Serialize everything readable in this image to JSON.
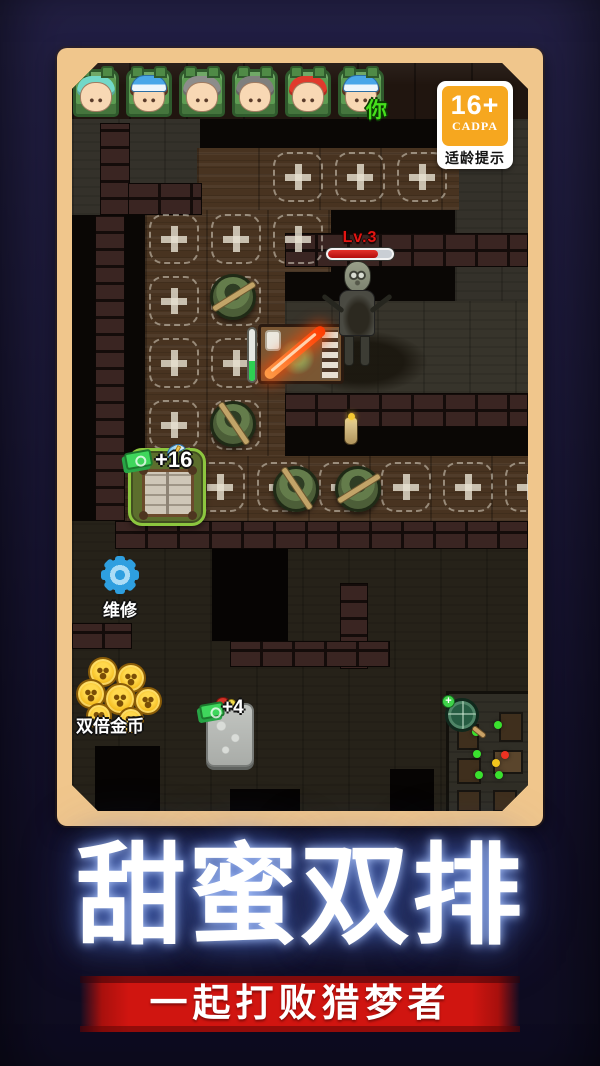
{
  "colors": {
    "frame_tan": "#f0c68c",
    "accent_green": "#8cc63f",
    "banner_red": "#d01510",
    "age_badge_orange": "#f6a71f",
    "hp_red": "#d01414",
    "gear_blue": "#2e9fe0",
    "coin_gold": "#f5bd20",
    "you_green": "#46e01c"
  },
  "lobby": {
    "you_label": "你",
    "players": [
      {
        "hair": "#72d8c8",
        "hat": false,
        "you": false
      },
      {
        "hair": "#6e422a",
        "hat": true,
        "you": false
      },
      {
        "hair": "#8d8d8b",
        "hat": false,
        "you": false
      },
      {
        "hair": "#7f7f7d",
        "hat": false,
        "you": false
      },
      {
        "hair": "#e03a2c",
        "hat": false,
        "you": false
      },
      {
        "hair": "#6e422a",
        "hat": true,
        "you": true
      }
    ]
  },
  "age_rating": {
    "number": "16+",
    "org": "CADPA",
    "caption": "适龄提示"
  },
  "enemy": {
    "level_label": "Lv.3",
    "hp_percent": 78
  },
  "station": {
    "progress": 38
  },
  "hud": {
    "build_bonus": "+16",
    "repair_label": "维修",
    "coins_label": "双倍金币",
    "rock_bonus": "+4"
  },
  "minimap": {
    "dots": [
      {
        "x": 62,
        "y": 26,
        "color": "#3ae12e"
      },
      {
        "x": 34,
        "y": 32,
        "color": "#3ae12e"
      },
      {
        "x": 36,
        "y": 50,
        "color": "#3ae12e"
      },
      {
        "x": 38,
        "y": 68,
        "color": "#3ae12e"
      },
      {
        "x": 63,
        "y": 68,
        "color": "#3ae12e"
      },
      {
        "x": 71,
        "y": 51,
        "color": "#ec3222"
      },
      {
        "x": 60,
        "y": 58,
        "color": "#f2c51d"
      }
    ]
  },
  "promo": {
    "title": "甜蜜双排",
    "subtitle": "一起打败猎梦者"
  }
}
